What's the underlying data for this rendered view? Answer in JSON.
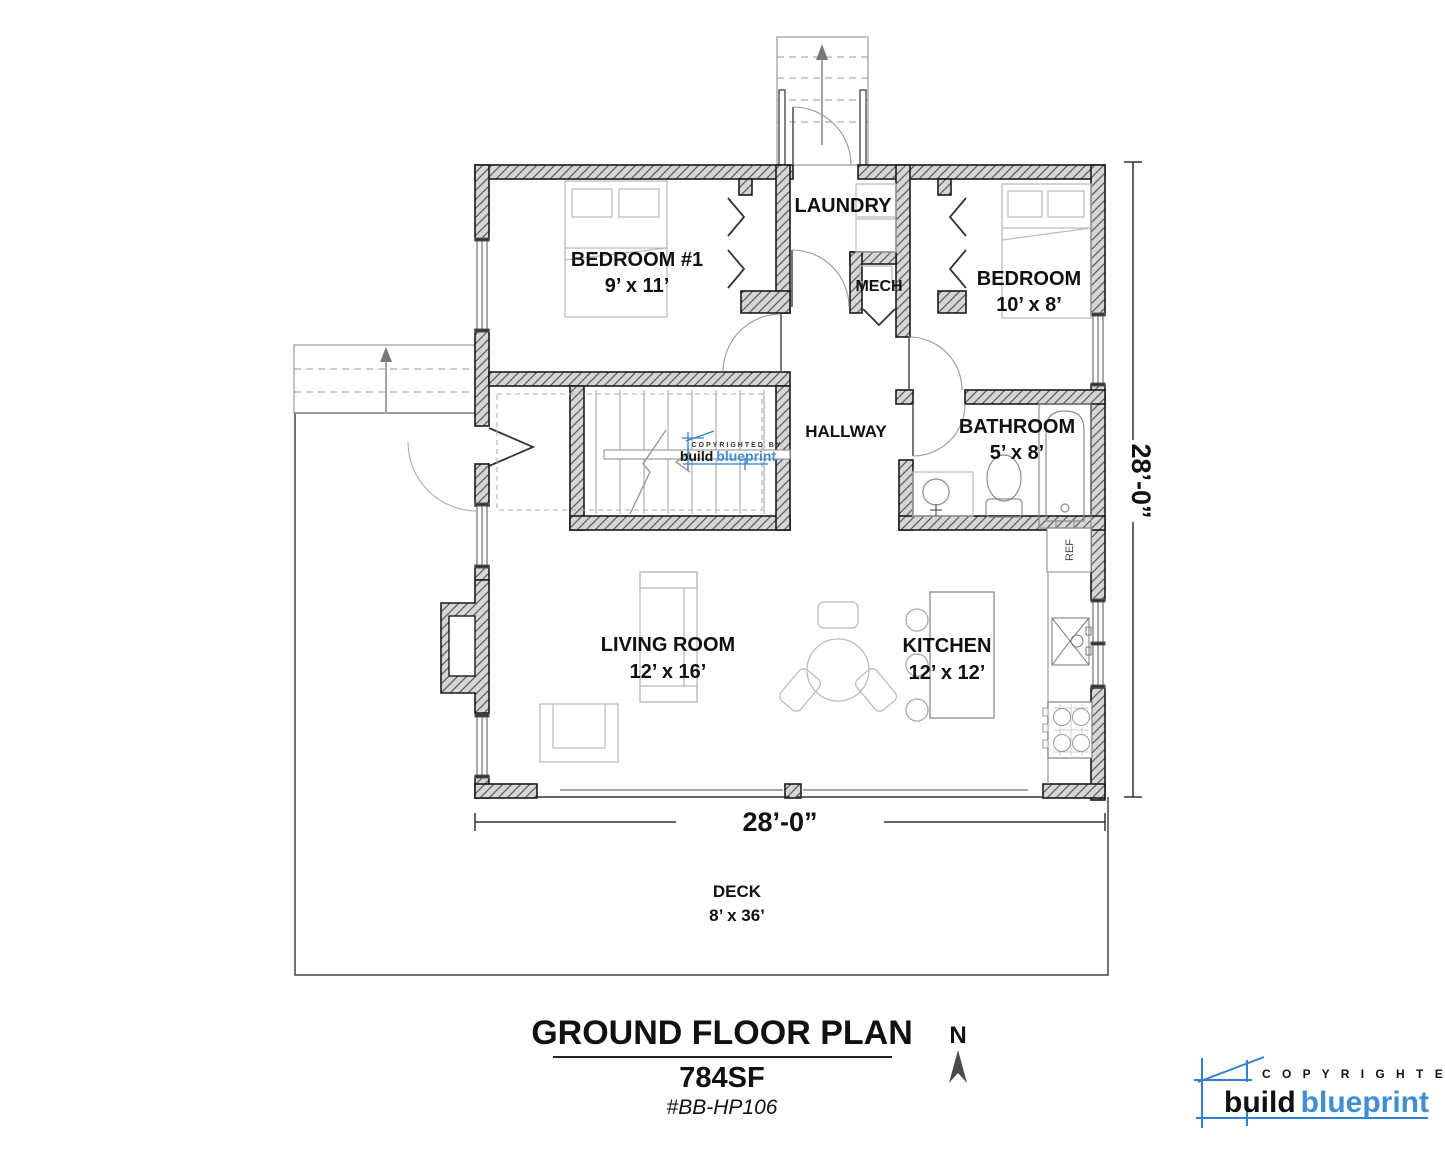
{
  "rooms": {
    "bedroom1": {
      "name": "BEDROOM #1",
      "dims": "9’ x 11’"
    },
    "laundry": {
      "name": "LAUNDRY"
    },
    "mech": {
      "name": "MECH"
    },
    "bedroom2": {
      "name": "BEDROOM",
      "dims": "10’ x 8’"
    },
    "hallway": {
      "name": "HALLWAY"
    },
    "bathroom": {
      "name": "BATHROOM",
      "dims": "5’ x 8’"
    },
    "living": {
      "name": "LIVING ROOM",
      "dims": "12’ x 16’"
    },
    "kitchen": {
      "name": "KITCHEN",
      "dims": "12’ x 12’"
    },
    "deck": {
      "name": "DECK",
      "dims": "8’ x 36’"
    }
  },
  "appliances": {
    "ref": "REF"
  },
  "dimensions": {
    "right": "28’-0”",
    "bottom": "28’-0”"
  },
  "title_block": {
    "title": "GROUND FLOOR PLAN",
    "area": "784SF",
    "plan_number": "#BB-HP106",
    "north_label": "N"
  },
  "watermark": {
    "copyrighted_by": "COPYRIGHTED BY",
    "build": "build",
    "blueprint": "blueprint"
  },
  "branding": {
    "copyrighted_by": "C O P Y R I G H T E D   B Y",
    "build": "build",
    "blueprint": "blueprint",
    "brand_blue": "#3e8ed6",
    "sketch_blue": "#2f7fd4"
  }
}
